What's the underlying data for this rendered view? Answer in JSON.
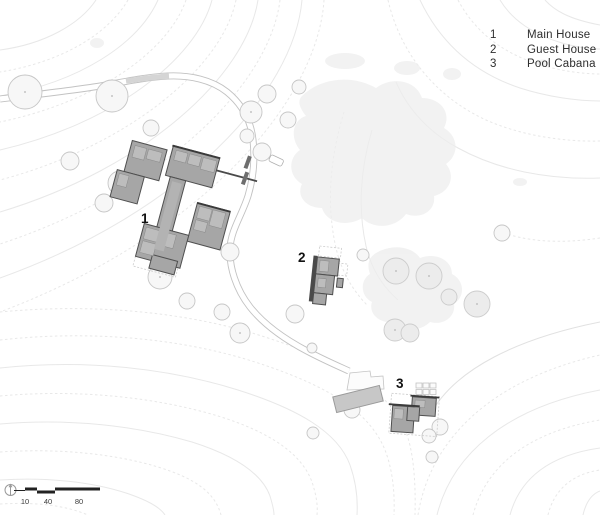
{
  "legend": {
    "items": [
      {
        "number": "1",
        "label": "Main House"
      },
      {
        "number": "2",
        "label": "Guest House"
      },
      {
        "number": "3",
        "label": "Pool Cabana"
      }
    ]
  },
  "plan_labels": {
    "main_house": "1",
    "guest_house": "2",
    "pool_cabana": "3"
  },
  "scale_bar": {
    "labels": [
      "10",
      "40",
      "80"
    ]
  },
  "icons": {
    "north_arrow": "north-arrow-icon"
  },
  "colors": {
    "building_fill": "#a6a6a6",
    "building_wall": "#4f4f4f",
    "pool_fill": "#c7c7c7",
    "tree_outline": "#c6c6c6",
    "contour_line": "#e8e8e8",
    "legend_text": "#2e2e2e"
  }
}
